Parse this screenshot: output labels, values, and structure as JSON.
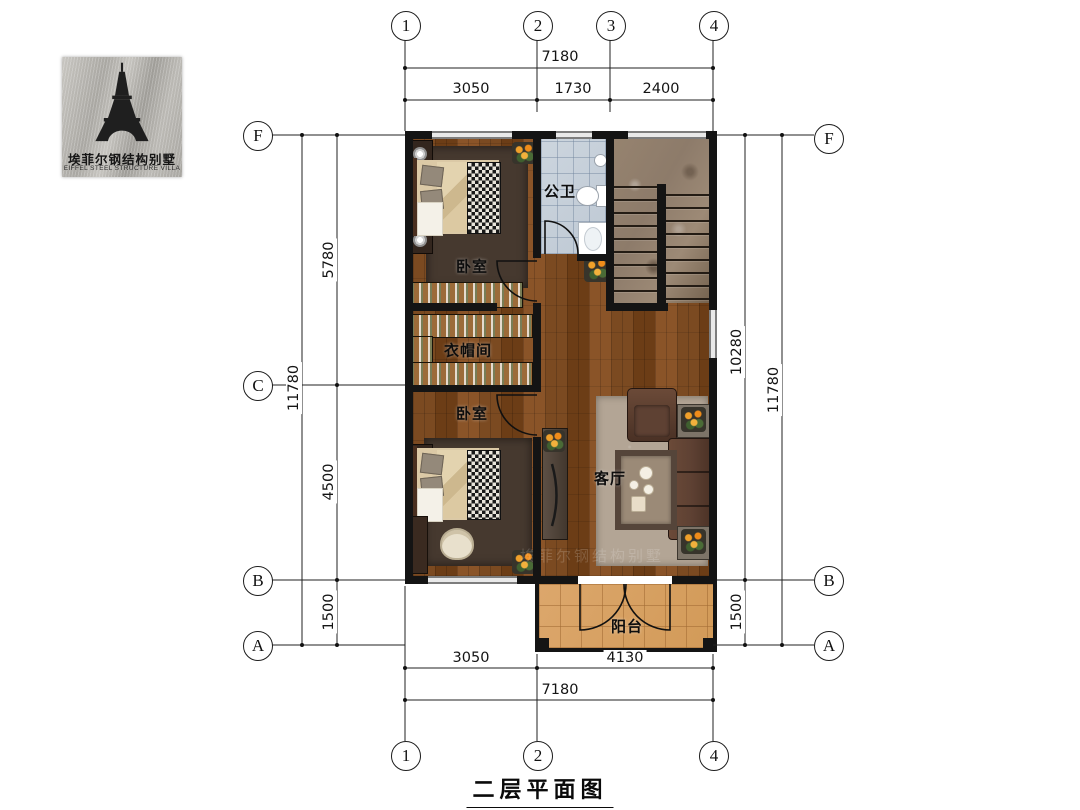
{
  "logo": {
    "cn": "埃菲尔钢结构别墅",
    "en": "EIFFEL STEEL STRUCTURE VILLA"
  },
  "sheet_title": "二层平面图",
  "grid": {
    "top": [
      "1",
      "2",
      "3",
      "4"
    ],
    "bottom": [
      "1",
      "2",
      "4"
    ],
    "left": [
      "F",
      "C",
      "B",
      "A"
    ],
    "right": [
      "F",
      "B",
      "A"
    ]
  },
  "dims": {
    "top_total": "7180",
    "top": [
      "3050",
      "1730",
      "2400"
    ],
    "left_total": "11780",
    "left": [
      "5780",
      "4500",
      "1500"
    ],
    "right_total": "11780",
    "right": [
      "10280",
      "1500"
    ],
    "bottom_total": "7180",
    "bottom": [
      "3050",
      "4130"
    ]
  },
  "rooms": {
    "bedroom1": "卧室",
    "bathroom": "公卫",
    "cloakroom": "衣帽间",
    "bedroom2": "卧室",
    "living": "客厅",
    "balcony": "阳台"
  },
  "watermark": "埃菲尔钢结构别墅",
  "colors": {
    "wall": "#141414",
    "wood": "#7b4a21",
    "bath_tile": "#ccd5de",
    "balcony_tile": "#dca76c",
    "marble": "#8d7b6a",
    "rug_dark": "#46392f",
    "rug_light": "#b3a595",
    "closet": "#9c6b39",
    "sofa": "#5e4133",
    "bed_cream": "#dbc9a6",
    "accent_flower": "#f0a02a"
  }
}
